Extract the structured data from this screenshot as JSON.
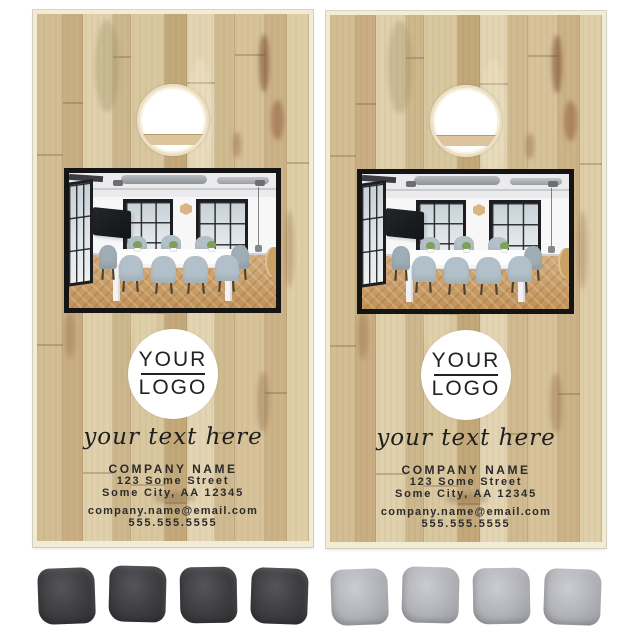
{
  "product": {
    "board_face": {
      "logo_line1": "YOUR",
      "logo_line2": "LOGO",
      "tagline": "your text here",
      "company_name": "COMPANY NAME",
      "address_line1": "123 Some Street",
      "address_line2": "Some City, AA 12345",
      "email": "company.name@email.com",
      "phone": "555.555.5555"
    },
    "boards": [
      {
        "id": "board-1",
        "bag_count": 4,
        "bag_color": "#3e3e41",
        "bag_shade": "#2d2d30",
        "bag_highlight": "#54545a"
      },
      {
        "id": "board-2",
        "bag_count": 4,
        "bag_color": "#b3b4b9",
        "bag_shade": "#97989e",
        "bag_highlight": "#cbccd1"
      }
    ],
    "colors": {
      "wood_base": "#d6c39b",
      "board_edge": "#f2ebd5",
      "text": "#2b2b2b",
      "logo_circle_bg": "#ffffff",
      "photo_border": "#141414",
      "hole_fill": "#ffffff",
      "hole_support_bar": "#dcc59c",
      "background": "#ffffff"
    }
  }
}
